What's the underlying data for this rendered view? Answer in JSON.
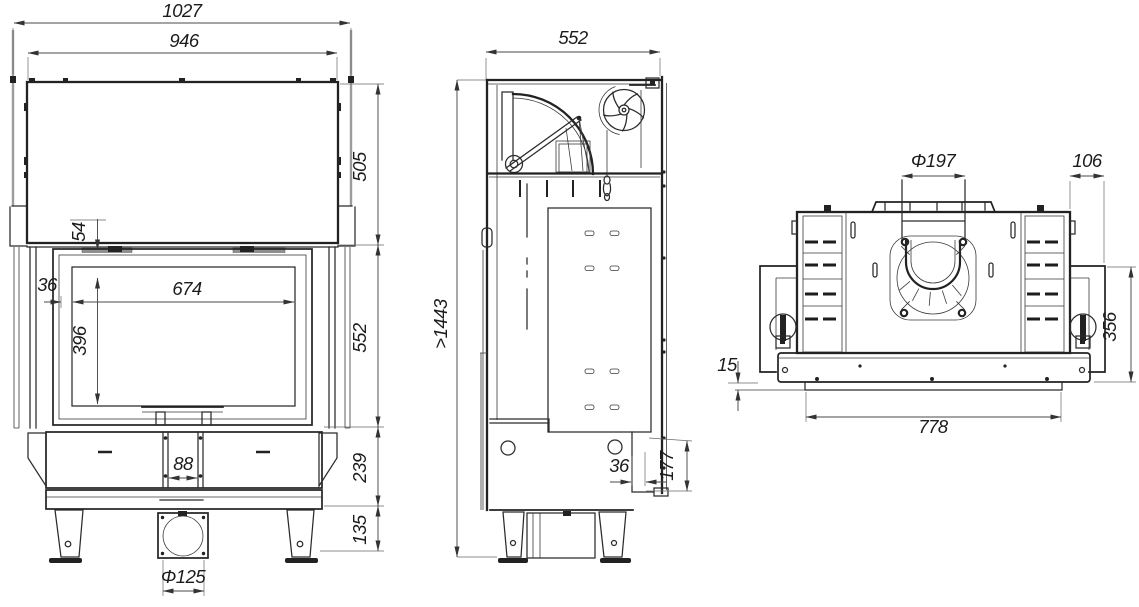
{
  "drawing_title": "fireplace-insert-dimension-drawing",
  "dims": {
    "front": {
      "overall_width": "1027",
      "hood_width": "946",
      "hood_height": "505",
      "top_offset": "54",
      "side_inset": "36",
      "glass_width": "674",
      "glass_height": "396",
      "middle_height": "552",
      "channel_width": "88",
      "base_height": "239",
      "foot_height": "135",
      "outlet_diameter": "Φ125"
    },
    "side": {
      "depth": "552",
      "total_height": ">1443",
      "rear_gap": "36",
      "outlet_height": "177"
    },
    "rear": {
      "flue_diameter": "Φ197",
      "side_offset": "106",
      "rear_height": "356",
      "lip_height": "15",
      "frame_width": "778"
    }
  }
}
